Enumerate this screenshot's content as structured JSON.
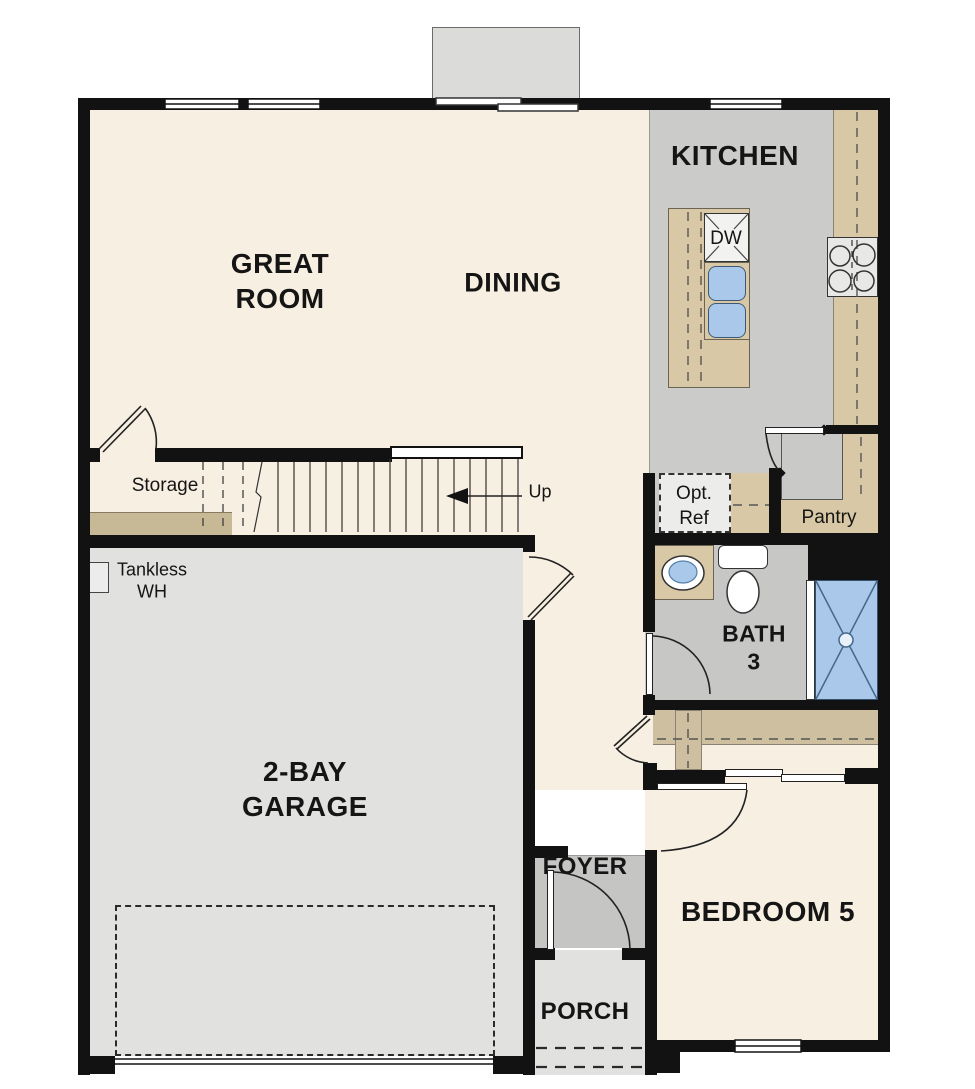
{
  "plan": {
    "rooms": {
      "kitchen": {
        "label": "KITCHEN"
      },
      "great_room": {
        "line1": "GREAT",
        "line2": "ROOM"
      },
      "dining": {
        "label": "DINING"
      },
      "garage": {
        "line1": "2-BAY",
        "line2": "GARAGE"
      },
      "bath3": {
        "line1": "BATH",
        "line2": "3"
      },
      "bedroom5": {
        "label": "BEDROOM 5"
      },
      "foyer": {
        "label": "FOYER"
      },
      "porch": {
        "label": "PORCH"
      },
      "pantry": {
        "label": "Pantry"
      },
      "storage": {
        "label": "Storage"
      }
    },
    "fixtures": {
      "dishwasher": {
        "label": "DW"
      },
      "opt_ref": {
        "line1": "Opt.",
        "line2": "Ref"
      },
      "tankless_wh": {
        "line1": "Tankless",
        "line2": "WH"
      }
    },
    "annotations": {
      "stairs_up": {
        "label": "Up"
      }
    },
    "colors": {
      "wall": "#121212",
      "floor_cream": "#f7efe1",
      "floor_kitchen_gray": "#cbcbca",
      "floor_bath_gray": "#c7c7c6",
      "floor_foyer_gray": "#c5c5c4",
      "floor_garage_gray": "#e1e1df",
      "counter_tan": "#d9c8a6",
      "closet_tan": "#cdbf9f",
      "shelf_tan": "#c7b896",
      "fixture_blue": "#a9c8ea",
      "bumpout_gray": "#dbdbda"
    }
  }
}
